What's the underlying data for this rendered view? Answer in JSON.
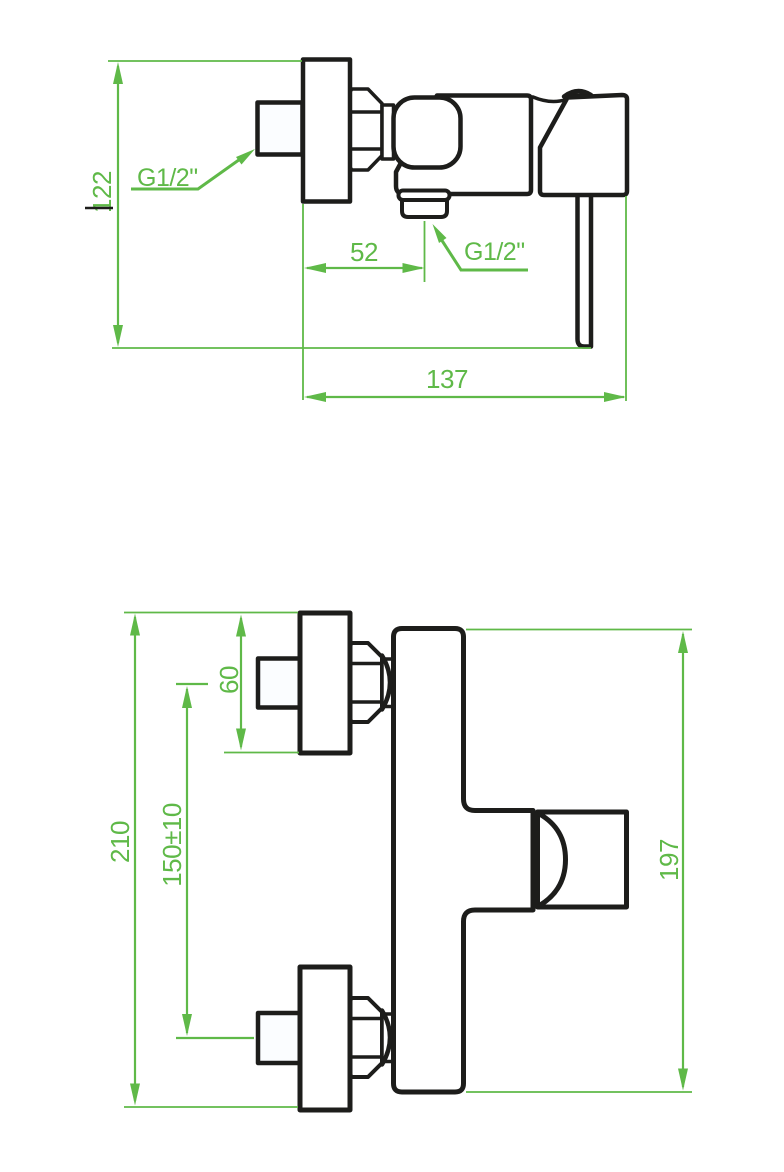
{
  "views": {
    "side_view": {
      "dimensions": {
        "height": "122",
        "spout_offset": "52",
        "depth": "137"
      },
      "threads": {
        "inlet": "G1/2\"",
        "outlet": "G1/2\""
      }
    },
    "front_view": {
      "dimensions": {
        "overall_height": "210",
        "connection_spacing": "150±10",
        "flange_height": "60",
        "body_height": "197"
      }
    }
  },
  "colors": {
    "dimension_green": "#5fb948",
    "drawing_black": "#1d1d1b"
  }
}
